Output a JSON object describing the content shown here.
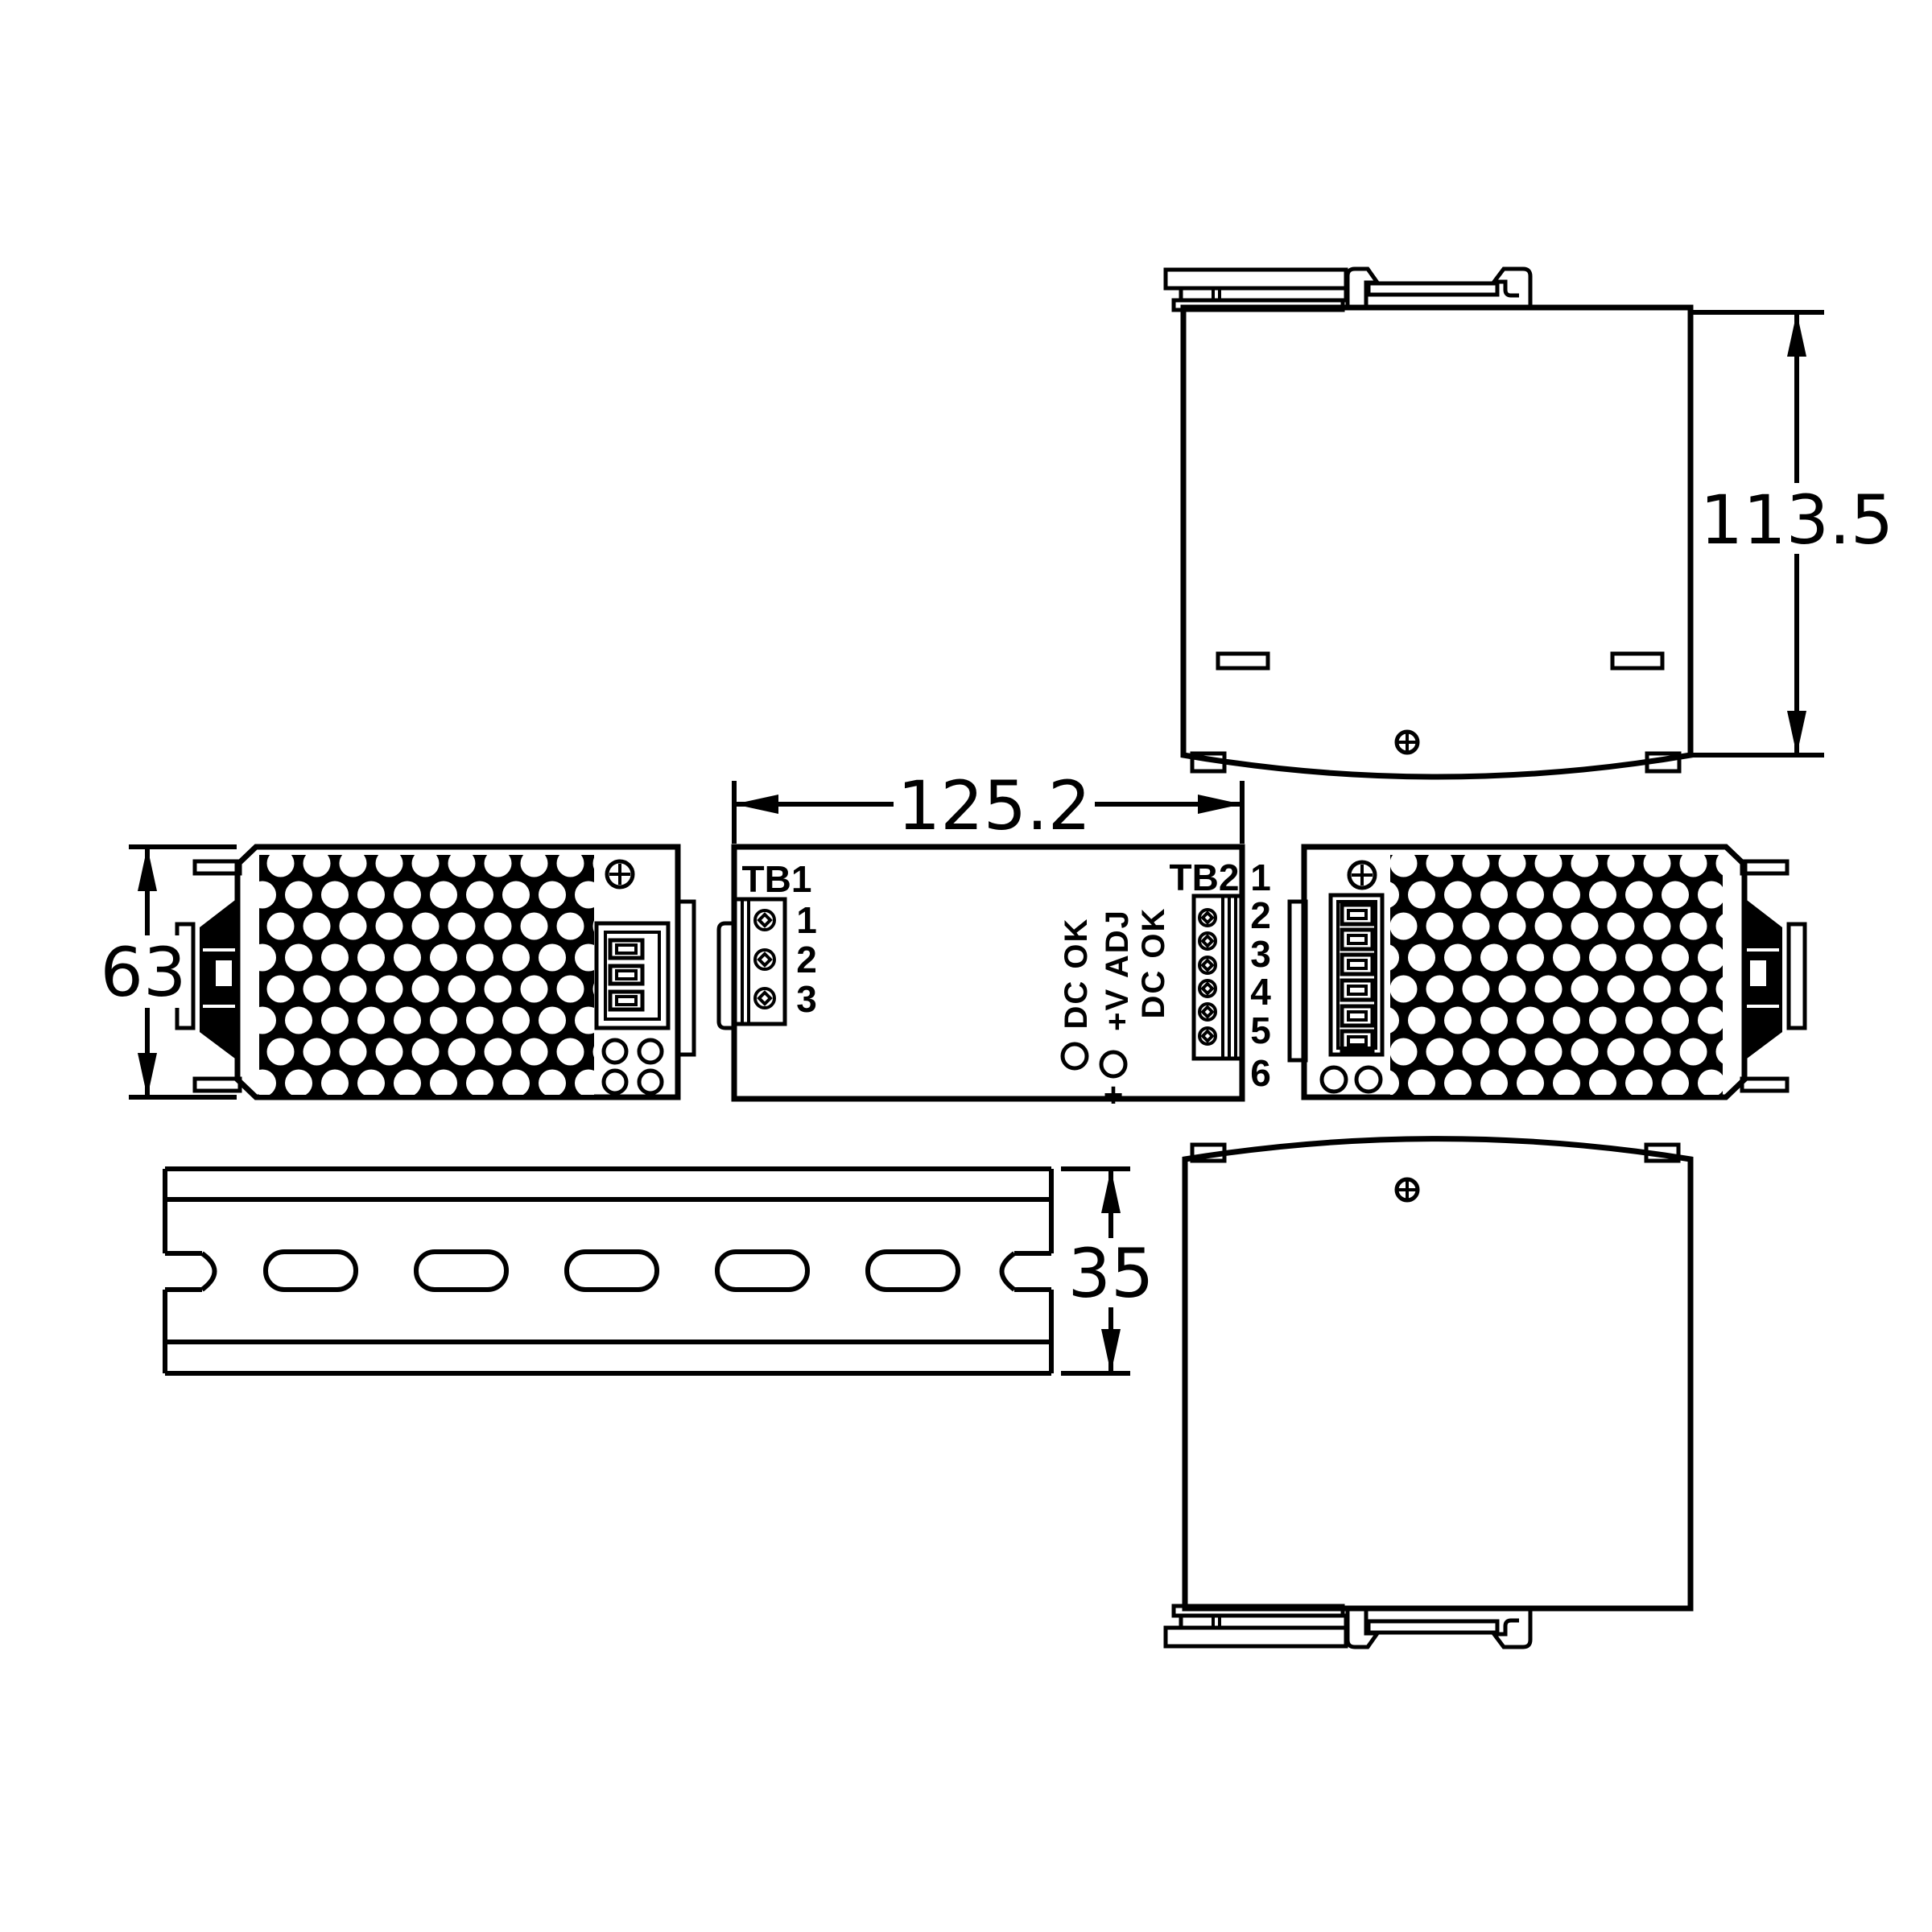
{
  "drawing_title": "DIN rail power supply mechanical dimension drawing",
  "dimensions": {
    "front_width": "125.2",
    "side_height": "113.5",
    "side_width": "63",
    "rail_size": "35"
  },
  "front_view": {
    "tb1": {
      "label": "TB1",
      "pins": [
        "1",
        "2",
        "3"
      ]
    },
    "tb2": {
      "label": "TB2",
      "pins": [
        "1",
        "2",
        "3",
        "4",
        "5",
        "6"
      ]
    },
    "indicators": {
      "dc_ok_inner": "DC OK",
      "v_adj": "+V ADJ",
      "dc_ok_outer": "DC OK",
      "polarity": "+"
    }
  },
  "colors": {
    "line": "#000000",
    "background": "#ffffff"
  }
}
